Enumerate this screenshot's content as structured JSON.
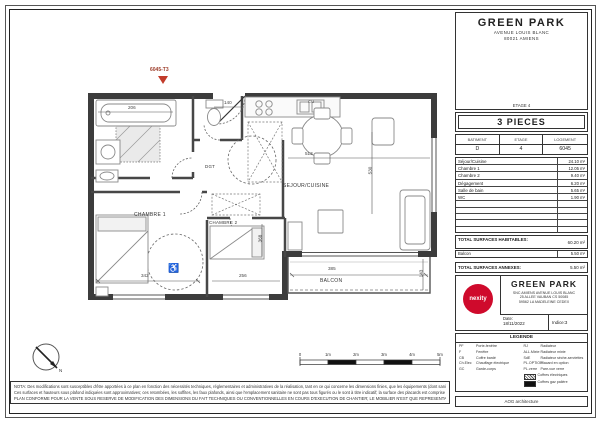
{
  "plan": {
    "unit_label": "6045-T3",
    "rooms": {
      "sejour": "SEJOUR/CUISINE",
      "chambre1": "CHAMBRE 1",
      "chambre2": "CHAMBRE 2",
      "degagement": "DGT",
      "balcon": "BALCON",
      "cuisine_tag": "CU"
    },
    "dimensions": {
      "bathtub": "206",
      "entry": "140",
      "sejour_width": "513",
      "sejour_height": "530",
      "chambre1_width": "342",
      "chambre2_width": "256",
      "balcon_width": "385",
      "chambre2_height": "368",
      "balcon_depth": "143"
    },
    "scalebar": [
      "0",
      "1m",
      "2m",
      "3m",
      "4m",
      "5m"
    ],
    "north_label": "N"
  },
  "titleblock": {
    "project_name": "GREEN PARK",
    "project_address1": "AVENUE LOUIS BLANC",
    "project_address2": "80021 AMIENS",
    "etage_caption": "ETAGE 4",
    "type_label": "3 PIECES",
    "unit_table": {
      "headers": [
        "BATIMENT",
        "ETAGE",
        "LOGEMENT"
      ],
      "values": [
        "D",
        "4",
        "6045"
      ]
    },
    "surfaces": [
      {
        "label": "Séjour/Cuisine",
        "value": "24.10 m²"
      },
      {
        "label": "Chambre 1",
        "value": "12.05 m²"
      },
      {
        "label": "Chambre 2",
        "value": "9.40 m²"
      },
      {
        "label": "Dégagement",
        "value": "6.20 m²"
      },
      {
        "label": "Salle de bain",
        "value": "5.65 m²"
      },
      {
        "label": "WC",
        "value": "1.90 m²"
      }
    ],
    "totals": {
      "habitables_label": "TOTAL SURFACES HABITABLES:",
      "habitables_value": "60.20 m²",
      "balcon_label": "Balcon",
      "balcon_value": "5.50 m²",
      "annexes_label": "TOTAL SURFACES ANNEXES:",
      "annexes_value": "5.50 m²"
    },
    "developer": {
      "brand": "nexity",
      "project": "GREEN PARK",
      "address_lines": [
        "SNC AMIENS AVENUE LOUIS BLANC",
        "25 ALLEE VAUBAN CS 50085",
        "59562 LA MADELEINE CEDEX"
      ],
      "date_label": "Date:",
      "date_value": "18/11/2022",
      "indice": "Indice:3"
    },
    "legend": {
      "title": "LEGENDE",
      "left": [
        {
          "abbr": "PF",
          "label": "Porte-fenêtre"
        },
        {
          "abbr": "F",
          "label": "Fenêtre"
        },
        {
          "abbr": "CB",
          "label": "Coffre bardé"
        },
        {
          "abbr": "Ch.Elec",
          "label": "Chauffage électrique"
        },
        {
          "abbr": "GC",
          "label": "Garde-corps"
        }
      ],
      "right": [
        {
          "abbr": "RJ",
          "label": "Radiateur"
        },
        {
          "abbr": "ALL.Mixte",
          "label": "Radiateur mixte"
        },
        {
          "abbr": "SdE",
          "label": "Radiateur sèche-serviettes"
        },
        {
          "abbr": "PL.OPTION",
          "label": "Placard en option"
        },
        {
          "abbr": "PL.verre",
          "label": "Pare-vue verre"
        }
      ],
      "swatches": [
        {
          "label": "Coffres électriques"
        },
        {
          "label": "Coffres gaz palière"
        }
      ]
    },
    "credit": "AOG architecture"
  },
  "nota": {
    "line1": "NOTA: Des modifications sont susceptibles d'être apportées à ce plan en fonction des nécessités techniques, réglementaires et administratives de la réalisation, tant en ce qui concerne les dimensions finies, que les équipements (dont sanitaires et électriques).",
    "line2": "Ces surfaces et hauteurs sous plafond indiquées sont approximatives; ces retombées, les soffites, les faux plafonds, ainsi que l'emplacement sanitaire ne sont pas tous figurés ou le sont à titre indicatif; la surface des placards est comprise dans la surface des pièces attenantes.",
    "line3": "PLAN CONFORME POUR LA VENTE SOUS RESERVE DE MODIFICATION DES DIMENSIONS DU FAIT TECHNIQUES OU CONVENTIONNELLES EN COURS D'EXECUTION DE CHANTIER; LE MOBILIER N'EST QUE REPRESENTATIF ET NON FOURNI."
  }
}
